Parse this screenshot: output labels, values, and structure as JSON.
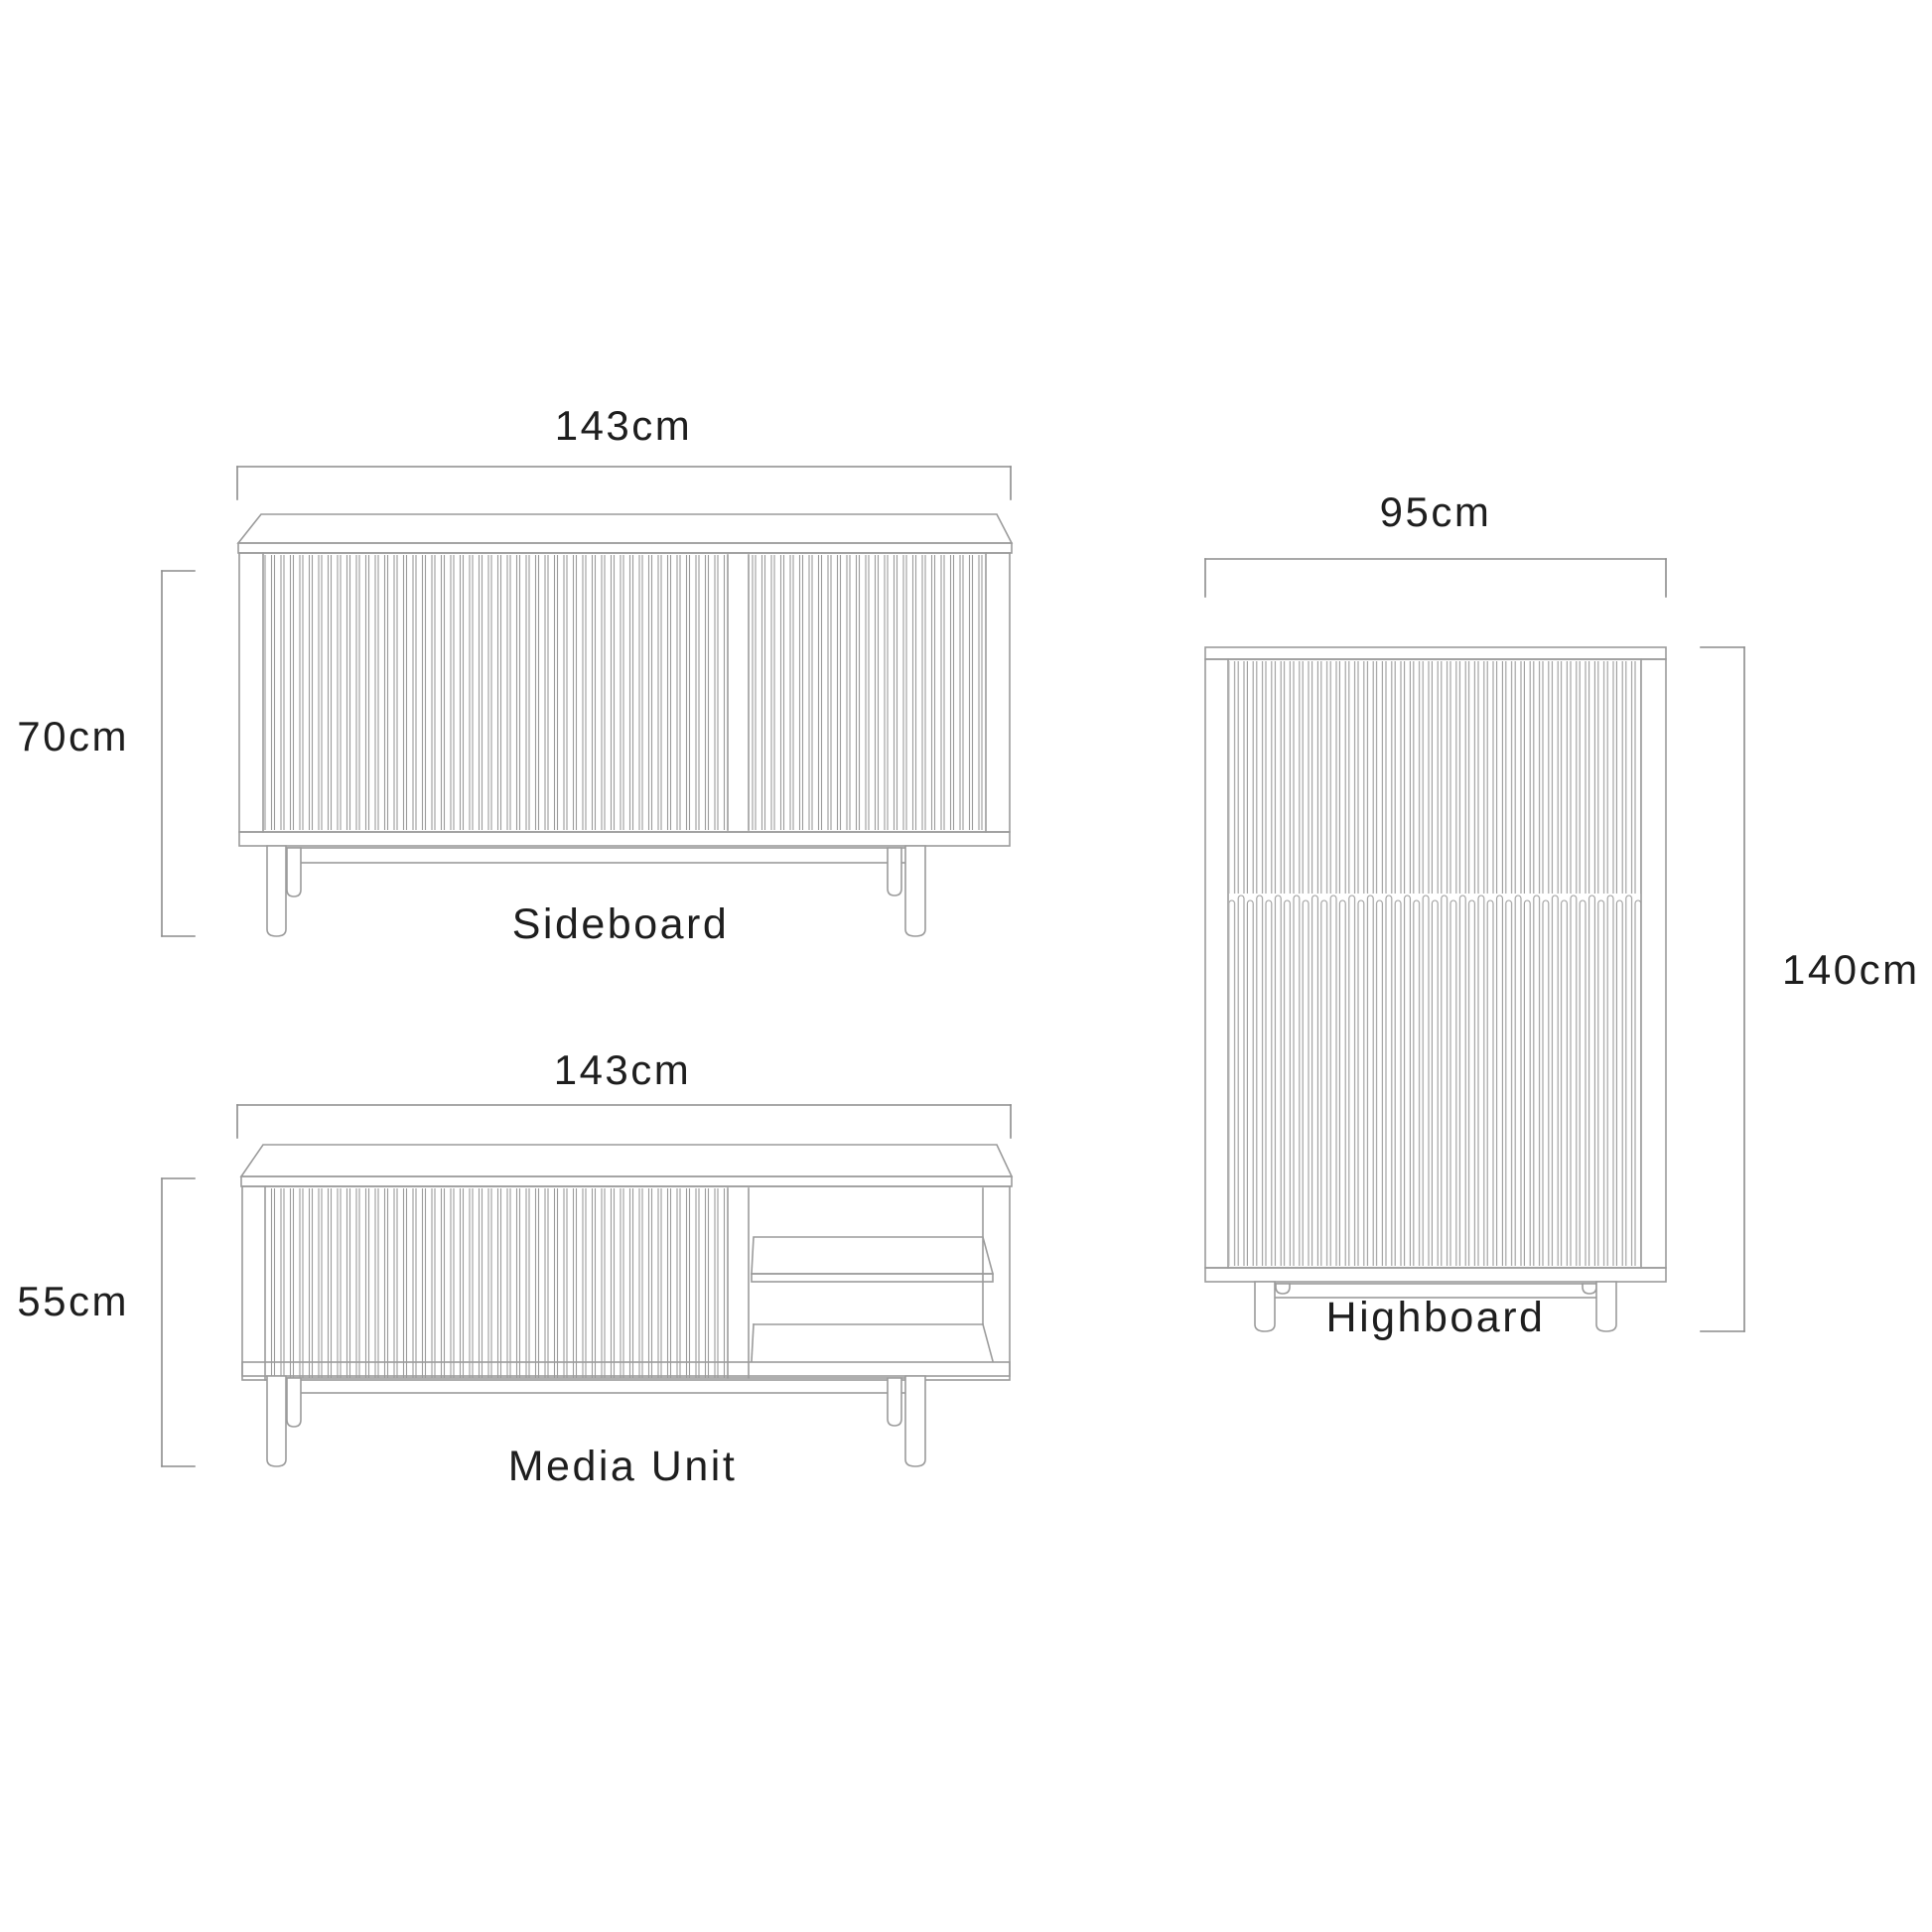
{
  "diagram": {
    "type": "furniture-dimension-drawing",
    "colors": {
      "line": "#9b9b9b",
      "dim": "#8c8c8c",
      "text": "#1e1e1e",
      "background": "#ffffff"
    },
    "sideboard": {
      "label": "Sideboard",
      "width_label": "143cm",
      "height_label": "70cm"
    },
    "media_unit": {
      "label": "Media Unit",
      "width_label": "143cm",
      "height_label": "55cm"
    },
    "highboard": {
      "label": "Highboard",
      "width_label": "95cm",
      "height_label": "140cm"
    }
  }
}
